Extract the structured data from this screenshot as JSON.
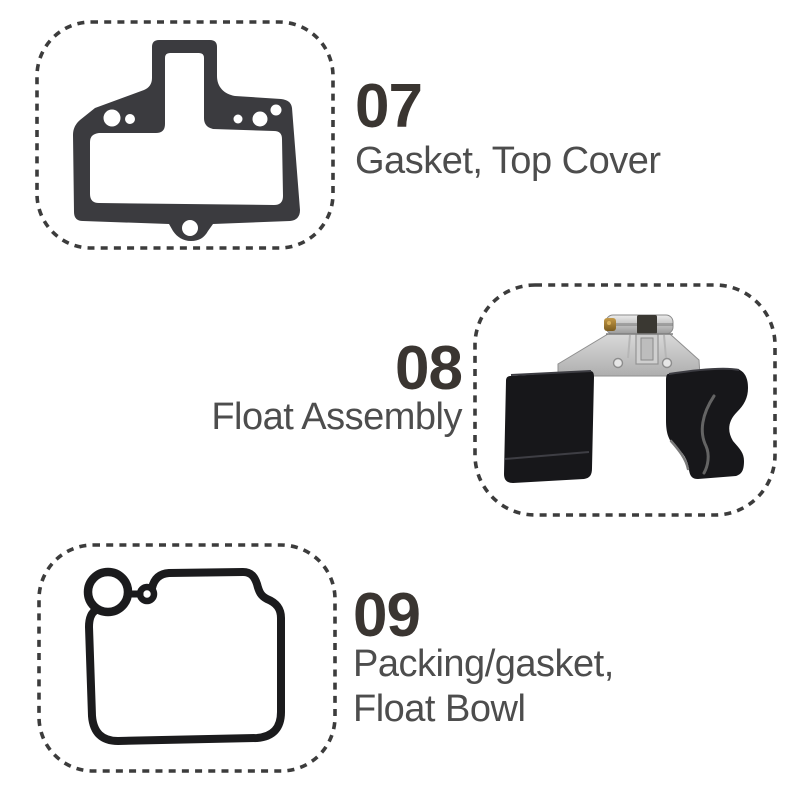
{
  "page": {
    "background": "#ffffff",
    "description": "Carburetor repair kit parts diagram"
  },
  "colors": {
    "page_bg": "#ffffff",
    "number_color": "#3a3531",
    "label_color": "#4d4d4d",
    "dash_color": "#3c3c3c",
    "gasket_fill": "#3b3b3f",
    "rubber_stroke": "#1b1b1d",
    "float_fill": "#17171a",
    "metal_light": "#e4e4e4",
    "metal_dark": "#a2a2a2",
    "brass": "#a5812f"
  },
  "items": [
    {
      "number": "07",
      "label_line1": "Gasket, Top Cover",
      "label_line2": "",
      "part_icon": "top-cover-gasket"
    },
    {
      "number": "08",
      "label_line1": "Float Assembly",
      "label_line2": "",
      "part_icon": "float-assembly"
    },
    {
      "number": "09",
      "label_line1": "Packing/gasket,",
      "label_line2": "Float Bowl",
      "part_icon": "float-bowl-gasket"
    }
  ]
}
